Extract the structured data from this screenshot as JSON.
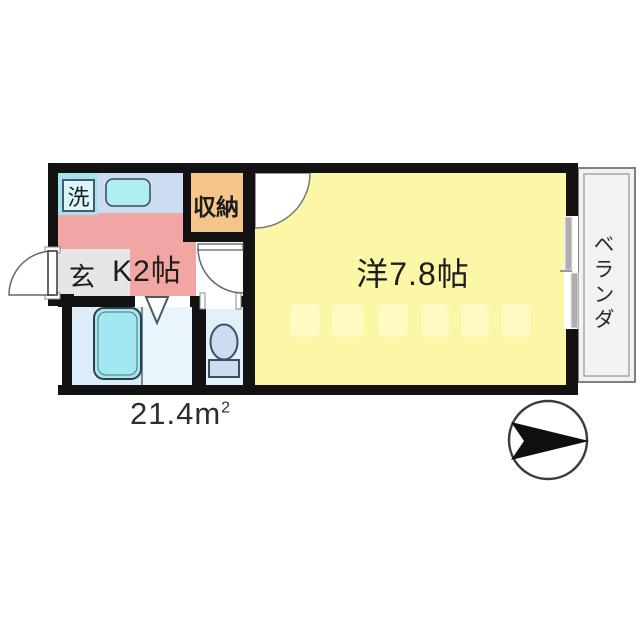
{
  "floorplan": {
    "rooms": {
      "laundry": {
        "label": "洗"
      },
      "kitchen": {
        "label": "K2帖"
      },
      "entrance": {
        "label": "玄"
      },
      "storage": {
        "label": "収納"
      },
      "main_room": {
        "label": "洋7.8帖"
      },
      "balcony": {
        "label": "ベランダ"
      }
    },
    "total_area": {
      "value": "21.4m",
      "superscript": "2"
    },
    "compass": {
      "direction": "right"
    },
    "colors": {
      "wall": "#121212",
      "kitchen": "#f2a6a3",
      "main_room": "#fbf7a6",
      "storage": "#f5c689",
      "laundry": "#a6e2f2",
      "entrance_floor": "#e6e6e6",
      "sink_counter": "#ccdcf0",
      "sink_basin": "#aceef2",
      "bath": "#dcedf9",
      "washroom": "#e9f4fb",
      "toilet_room": "#e2f0fa",
      "bathtub": "#a2e8f0",
      "toilet_fixture": "#cdddf1",
      "balcony": "#f2f2f2"
    }
  }
}
